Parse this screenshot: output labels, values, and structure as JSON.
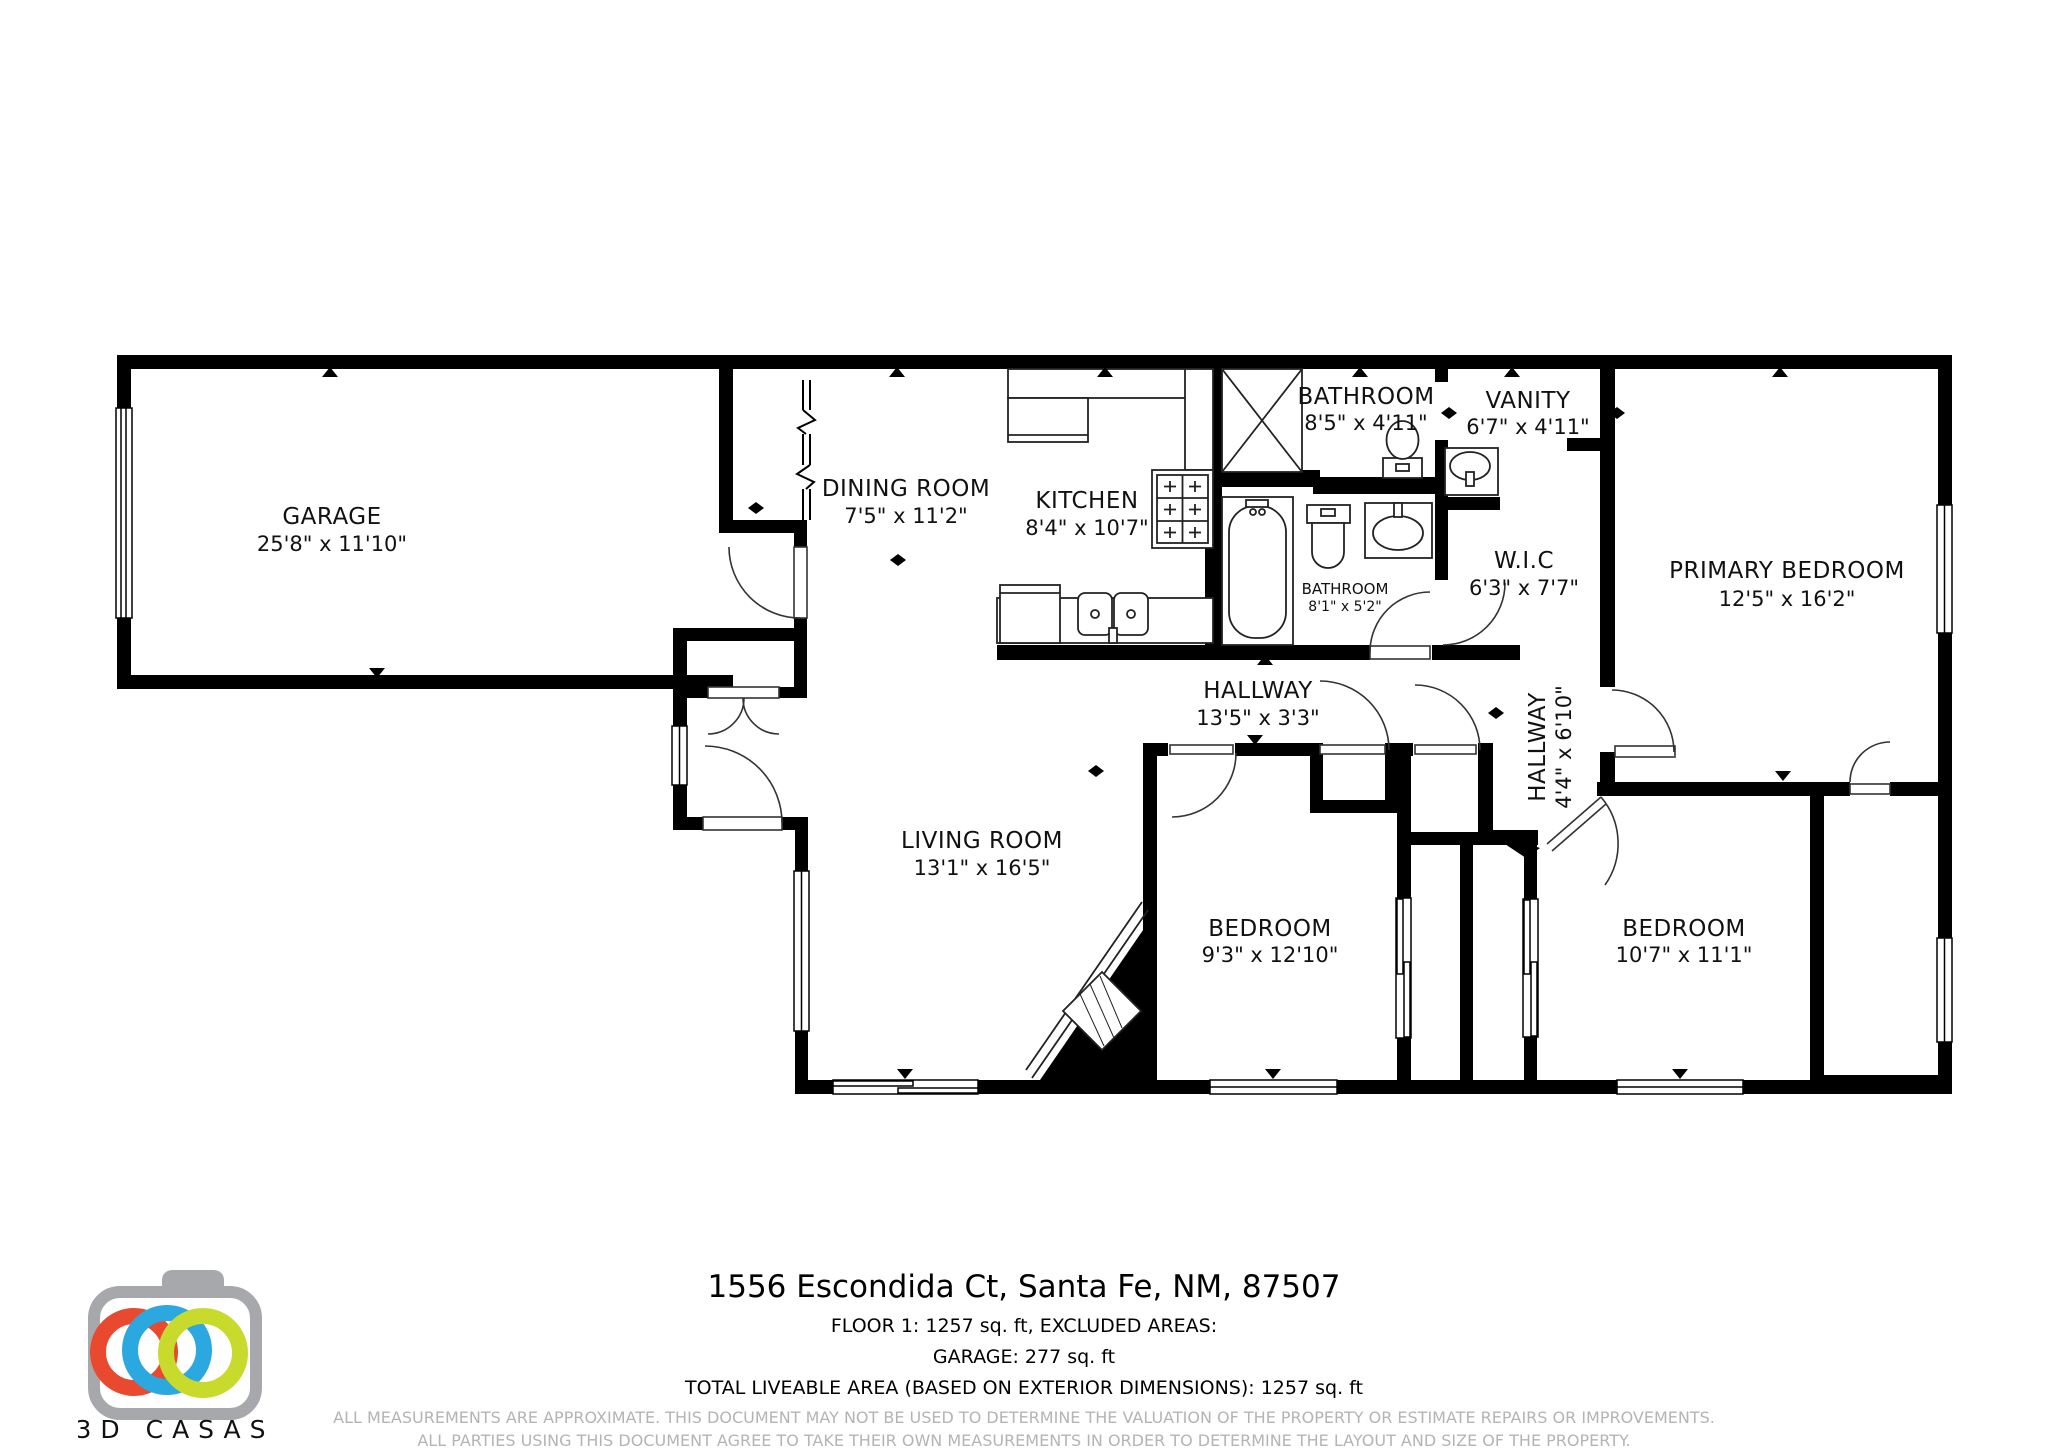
{
  "rooms": {
    "garage": {
      "name": "GARAGE",
      "dims": "25'8\" x 11'10\""
    },
    "dining": {
      "name": "DINING ROOM",
      "dims": "7'5\" x 11'2\""
    },
    "kitchen": {
      "name": "KITCHEN",
      "dims": "8'4\" x 10'7\""
    },
    "bathroom1": {
      "name": "BATHROOM",
      "dims": "8'5\" x 4'11\""
    },
    "vanity": {
      "name": "VANITY",
      "dims": "6'7\" x 4'11\""
    },
    "wic": {
      "name": "W.I.C",
      "dims": "6'3\" x 7'7\""
    },
    "bathroom2": {
      "name": "BATHROOM",
      "dims": "8'1\" x 5'2\""
    },
    "hallway1": {
      "name": "HALLWAY",
      "dims": "13'5\" x 3'3\""
    },
    "hallway2": {
      "name": "HALLWAY",
      "dims": "4'4\" x 6'10\""
    },
    "living": {
      "name": "LIVING ROOM",
      "dims": "13'1\" x 16'5\""
    },
    "bedroom1": {
      "name": "BEDROOM",
      "dims": "9'3\" x 12'10\""
    },
    "bedroom2": {
      "name": "BEDROOM",
      "dims": "10'7\" x 11'1\""
    },
    "primary": {
      "name": "PRIMARY BEDROOM",
      "dims": "12'5\" x 16'2\""
    }
  },
  "footer": {
    "address": "1556 Escondida Ct, Santa Fe, NM, 87507",
    "line1": "FLOOR 1: 1257 sq. ft, EXCLUDED AREAS:",
    "line2": "GARAGE: 277 sq. ft",
    "line3": "TOTAL LIVEABLE AREA (BASED ON EXTERIOR DIMENSIONS): 1257 sq. ft",
    "disclaimer1": "ALL MEASUREMENTS ARE APPROXIMATE. THIS DOCUMENT MAY NOT BE USED TO DETERMINE THE VALUATION OF THE PROPERTY OR ESTIMATE REPAIRS OR IMPROVEMENTS.",
    "disclaimer2": "ALL PARTIES USING THIS DOCUMENT AGREE TO TAKE THEIR OWN MEASUREMENTS IN ORDER TO DETERMINE THE LAYOUT AND SIZE OF THE PROPERTY."
  },
  "logo": {
    "brand": "3D CASAS",
    "ring_colors": [
      "#e8492f",
      "#2aa8df",
      "#c8da2b"
    ],
    "body_color": "#a6a8ab"
  }
}
